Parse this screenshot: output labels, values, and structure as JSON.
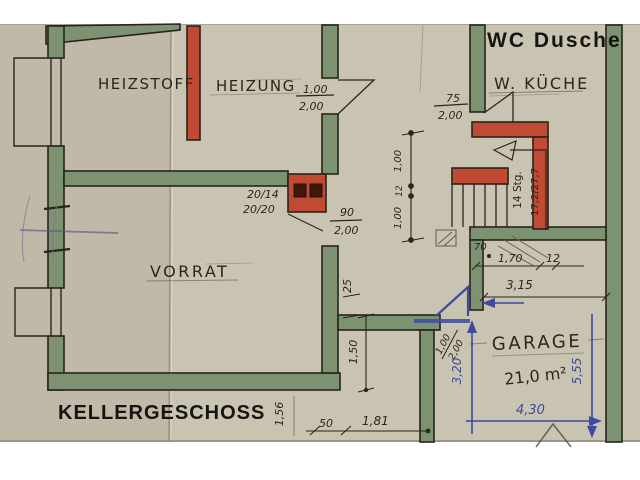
{
  "plan": {
    "title": "KELLERGESCHOSS",
    "rooms": {
      "wc_dusche": "WC Dusche",
      "w_kueche": "W. KÜCHE",
      "heizstoff": "HEIZSTOFF",
      "heizung": "HEIZUNG",
      "vorrat": "VORRAT",
      "garage": "GARAGE",
      "garage_area": "21,0 m²"
    },
    "stairs": {
      "steps": "14 Stg.",
      "rise_run": "17,2/27,7"
    },
    "chimney": {
      "flue1": "20/14",
      "flue2": "20/20"
    },
    "dims": {
      "heizung_door": {
        "w": "1,00",
        "h": "2,00"
      },
      "kueche_door": {
        "w": "75",
        "h": "2,00"
      },
      "vorrat_door": {
        "w": "90",
        "h": "2,00"
      },
      "garage_door": {
        "w": "1,00",
        "h": "2,00"
      },
      "chain": {
        "top": "1,00",
        "mid": "12",
        "bottom": "1,00"
      },
      "hall": {
        "a": "70",
        "b": "1,70",
        "c": "12"
      },
      "court_width": "3,15",
      "wall_thickness": "25",
      "niche_depth": "1,50",
      "left_len": "1,56",
      "seg_a": "50",
      "seg_b": "1,81",
      "garage_height_blue": "3,20",
      "garage_depth_blue": "5,55",
      "garage_width_blue": "4,30"
    },
    "colors": {
      "paper": "#c9c3b1",
      "wall_green": "#7d9270",
      "wall_red": "#c04a34",
      "ink": "#2b251d",
      "pen_blue": "#3d4ba0",
      "background": "#ffffff"
    }
  }
}
